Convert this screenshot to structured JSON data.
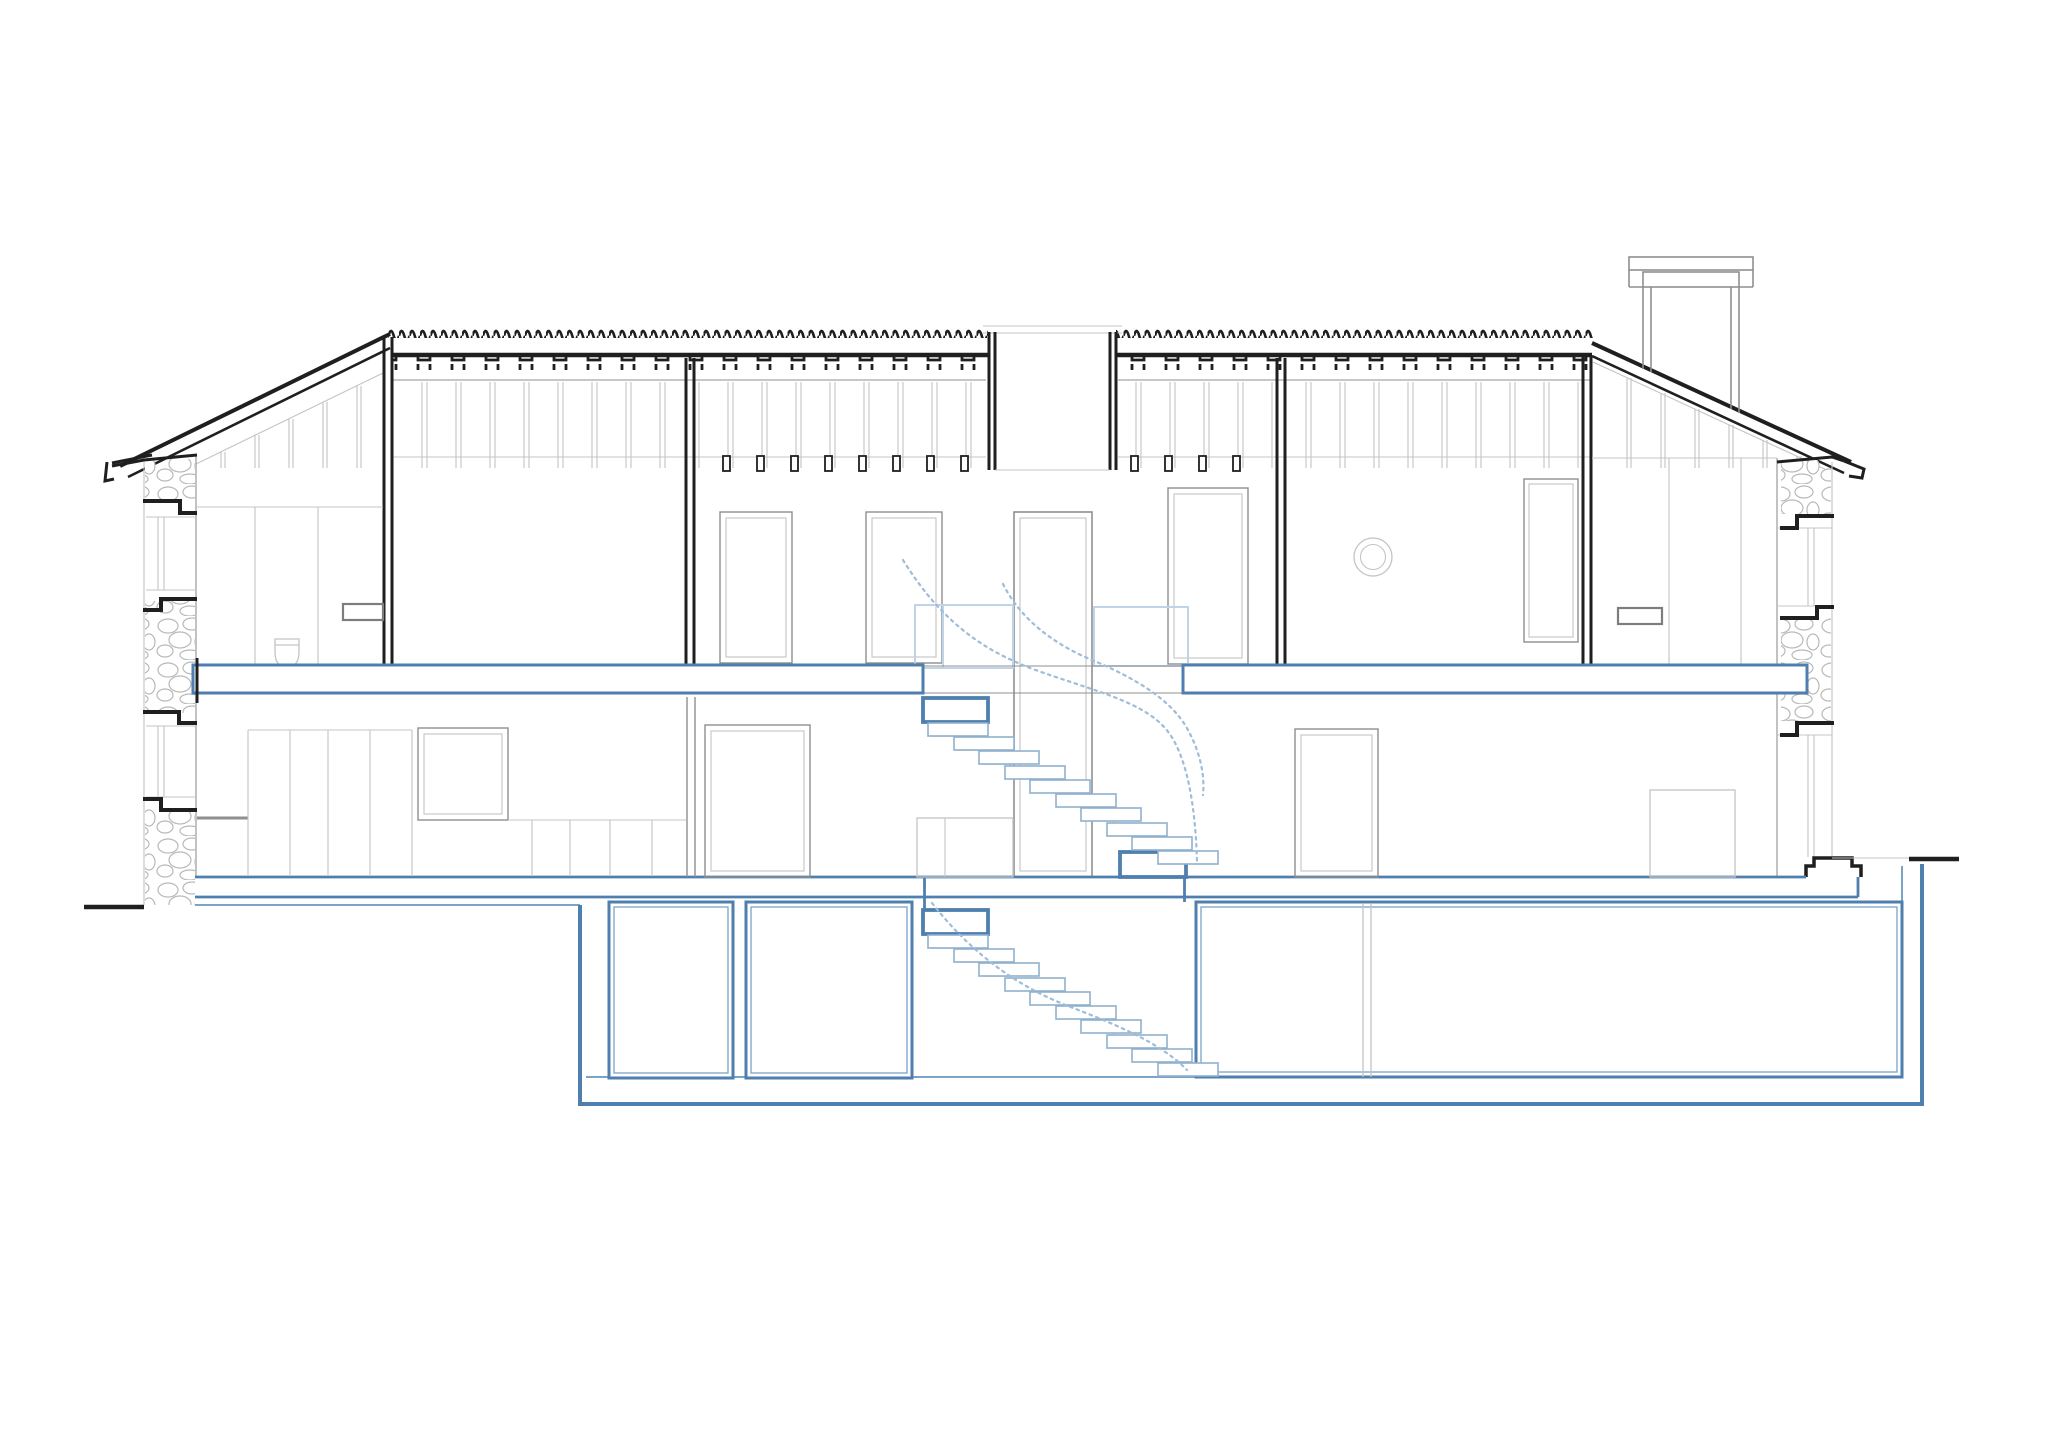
{
  "meta": {
    "title": "Residential building cross-section drawing",
    "drawing_type": "architectural section, line drawing, no text annotations"
  },
  "colors": {
    "bg": "#ffffff",
    "ink": "#1f1f1f",
    "gray": "#8f8f8f",
    "light": "#c4c4c4",
    "stoneLine": "#b9b9b9",
    "frame": "#7d7d7d",
    "blue": "#4e7fae",
    "blueMid": "#7ba3c6",
    "bluePale": "#bfd4e7",
    "treadEdge": "#8fb0cd",
    "rail": "#9fbcd9",
    "zigzag": "#c9c9c9"
  },
  "structure": {
    "storeys": [
      "attic under tiled roof",
      "upper floor",
      "ground floor",
      "basement"
    ],
    "cut_elements_blue": [
      "upper floor slabs",
      "stair landings",
      "ground slab",
      "basement walls and rooms"
    ],
    "stair_flights": [
      {
        "from": "ground floor",
        "to": "upper floor",
        "treads": 10
      },
      {
        "from": "basement",
        "to": "ground floor",
        "treads": 10
      }
    ],
    "roof": {
      "type": "double-pitched with flat tiled centre band",
      "ridge_opening": "central skylight shaft",
      "chimney": "right side"
    },
    "masonry": "rubble stone exterior walls left and right"
  }
}
